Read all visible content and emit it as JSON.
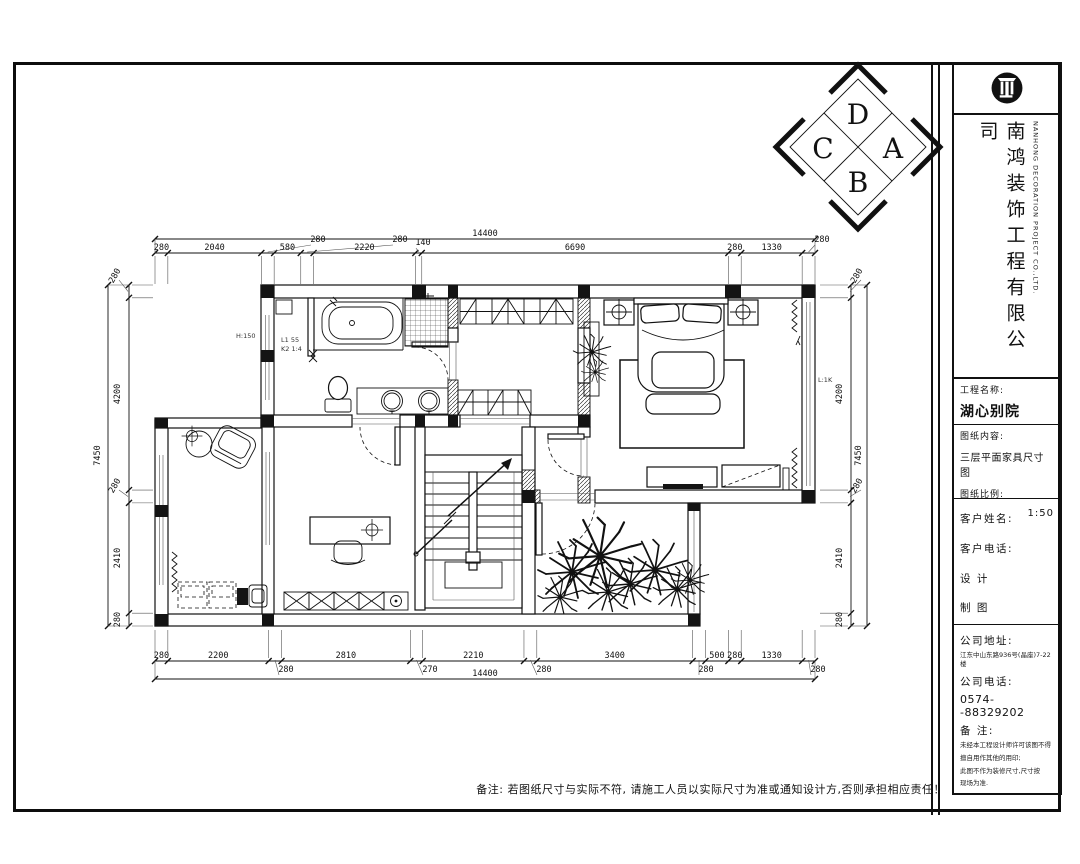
{
  "compass": {
    "top": "D",
    "right": "A",
    "bottom": "B",
    "left": "C"
  },
  "dims": {
    "top": {
      "overall": "14400",
      "chain": [
        "280",
        "2040",
        "280",
        "580",
        "280",
        "2220",
        "140",
        "6690",
        "280",
        "1330",
        "280"
      ]
    },
    "bottom": {
      "overall": "14400",
      "chain": [
        "280",
        "2200",
        "280",
        "2810",
        "270",
        "2210",
        "280",
        "3400",
        "280",
        "500",
        "280",
        "1330",
        "280"
      ]
    },
    "left": {
      "overall": "7450",
      "chain": [
        "280",
        "4200",
        "280",
        "2410",
        "280"
      ]
    },
    "right": {
      "overall": "7450",
      "chain": [
        "280",
        "4200",
        "280",
        "2410",
        "280"
      ]
    }
  },
  "annotations": {
    "bath_level": "H:150",
    "duct_line1": "L1 55",
    "duct_line2": "K2 1:4",
    "bedroom_level": "L:1K"
  },
  "footer": {
    "note": "备注: 若图纸尺寸与实际不符, 请施工人员以实际尺寸为准或通知设计方,否则承担相应责任！"
  },
  "title_block": {
    "company_cn": "南鸿装饰工程有限公司",
    "company_en": "NANHONG DECORATION PROJECT CO.,LTD.",
    "project_label": "工程名称:",
    "project_value": "湖心别院",
    "content_label": "图纸内容:",
    "content_value": "三层平面家具尺寸图",
    "scale_label": "图纸比例:",
    "scale_value": "1:50",
    "client_label": "客户姓名:",
    "phone_label": "客户电话:",
    "design_label": "设  计",
    "draft_label": "制  图",
    "address_label": "公司地址:",
    "address_value": "江东中山东路936号(晶座)7-22楼",
    "tel_label": "公司电话:",
    "tel_value": "0574--88329202",
    "note_label": "备  注:",
    "note_lines": [
      "未经本工程设计师许可该图不得",
      "擅自用作其他的用印;",
      "此图不作为装修尺寸,尺寸按",
      "现场为准."
    ]
  }
}
